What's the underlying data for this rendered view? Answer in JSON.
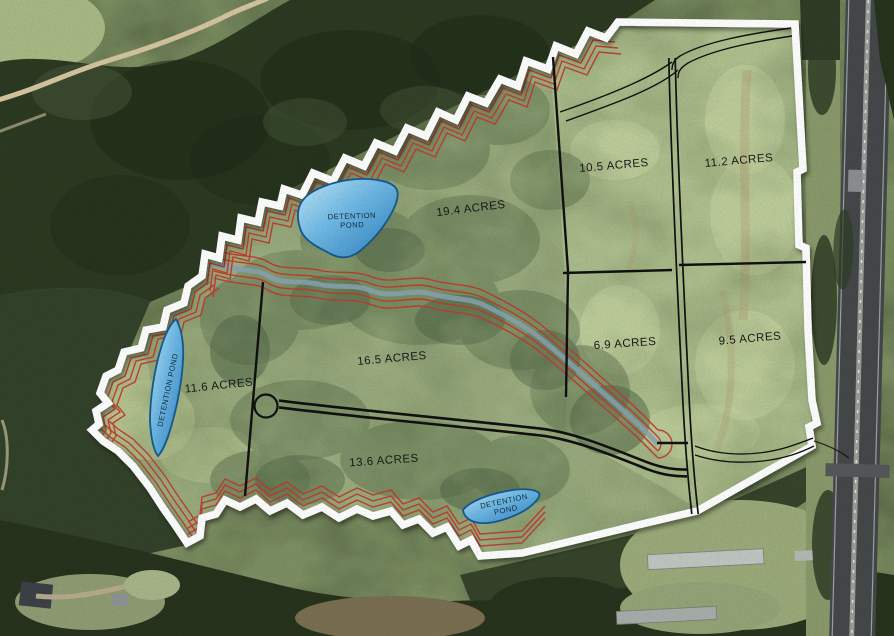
{
  "map": {
    "parcels": [
      {
        "id": "parcel-19-4",
        "label": "19.4 ACRES"
      },
      {
        "id": "parcel-10-5",
        "label": "10.5 ACRES"
      },
      {
        "id": "parcel-11-2",
        "label": "11.2 ACRES"
      },
      {
        "id": "parcel-6-9",
        "label": "6.9 ACRES"
      },
      {
        "id": "parcel-9-5",
        "label": "9.5 ACRES"
      },
      {
        "id": "parcel-16-5",
        "label": "16.5 ACRES"
      },
      {
        "id": "parcel-11-6",
        "label": "11.6 ACRES"
      },
      {
        "id": "parcel-13-6",
        "label": "13.6 ACRES"
      }
    ],
    "ponds": {
      "top": {
        "line1": "DETENTION",
        "line2": "POND"
      },
      "west": {
        "label": "DETENTION POND"
      },
      "south": {
        "line1": "DETENTION",
        "line2": "POND"
      }
    },
    "colors": {
      "boundary": "#ffffff",
      "contour_red": "#c23a2c",
      "parcel_line": "#111111",
      "road_line": "#111111",
      "creek": "#8aa4b5",
      "pond_light": "#c2e9fa",
      "pond_dark": "#2e7fc0",
      "pond_stroke": "#155a8e"
    }
  }
}
